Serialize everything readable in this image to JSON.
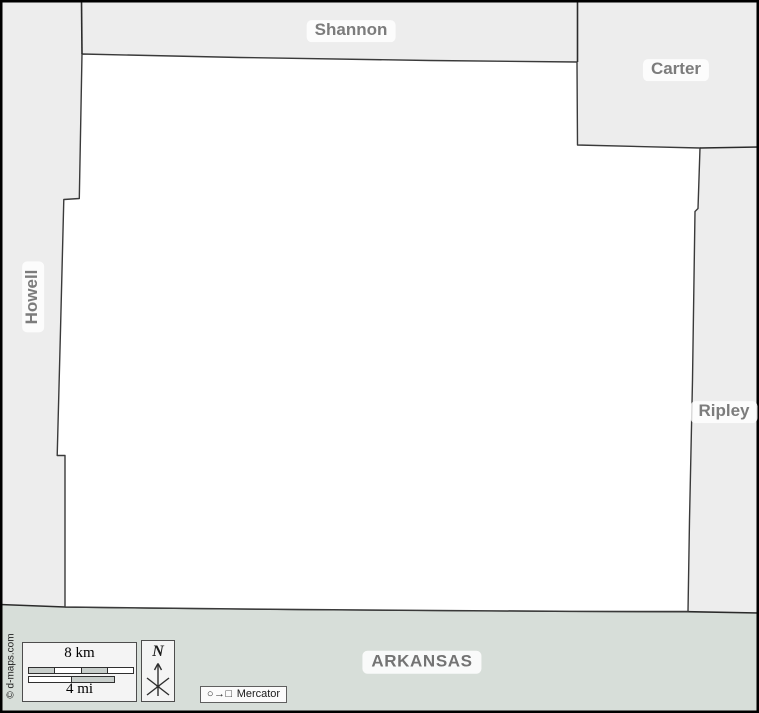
{
  "map": {
    "labels": {
      "top_neighbor": "Shannon",
      "top_right_neighbor": "Carter",
      "left_neighbor": "Howell",
      "right_neighbor": "Ripley",
      "bottom_state": "ARKANSAS"
    }
  },
  "scale": {
    "km_label": "8 km",
    "mi_label": "4 mi"
  },
  "compass": {
    "north_label": "N"
  },
  "projection": {
    "glyphs": "○→□",
    "name": "Mercator"
  },
  "credit": "© d-maps.com",
  "colors": {
    "neighbor_fill": "#ededed",
    "county_fill": "#ffffff",
    "state_band_fill": "#d7ded9",
    "border_stroke": "#3a3a3a",
    "frame_stroke": "#000000",
    "label_text": "#7c7c7c",
    "scale_segment_fill": "#c8cecb"
  }
}
